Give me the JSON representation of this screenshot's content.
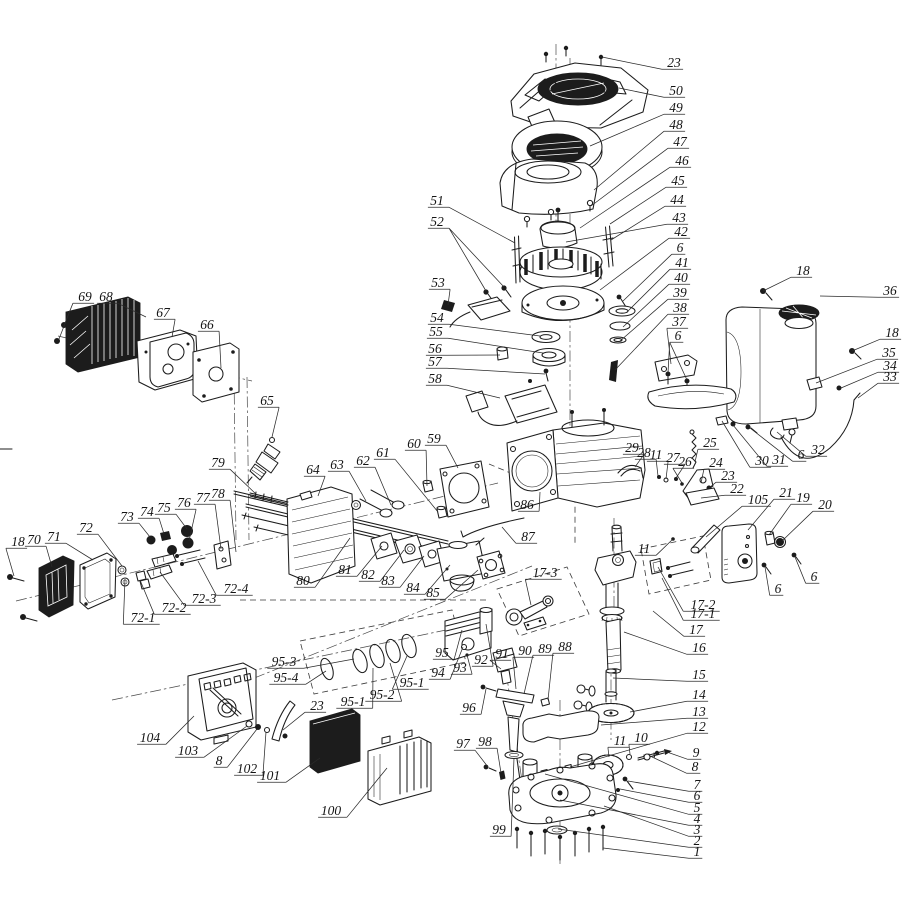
{
  "canvas": {
    "width": 905,
    "height": 905,
    "background": "#ffffff",
    "ink": "#1c1c1c"
  },
  "callouts": [
    {
      "n": "23",
      "x": 674,
      "y": 63,
      "t": [
        [
          602,
          57
        ]
      ]
    },
    {
      "n": "50",
      "x": 676,
      "y": 91,
      "t": [
        [
          619,
          88
        ]
      ]
    },
    {
      "n": "49",
      "x": 676,
      "y": 108,
      "t": [
        [
          590,
          146
        ]
      ]
    },
    {
      "n": "48",
      "x": 676,
      "y": 125,
      "t": [
        [
          594,
          190
        ]
      ]
    },
    {
      "n": "47",
      "x": 680,
      "y": 142,
      "t": [
        [
          591,
          206
        ]
      ]
    },
    {
      "n": "46",
      "x": 682,
      "y": 161,
      "t": [
        [
          580,
          228
        ]
      ]
    },
    {
      "n": "45",
      "x": 678,
      "y": 181,
      "t": [
        [
          610,
          224
        ]
      ]
    },
    {
      "n": "44",
      "x": 677,
      "y": 200,
      "t": [
        [
          611,
          240
        ]
      ]
    },
    {
      "n": "43",
      "x": 679,
      "y": 218,
      "t": [
        [
          566,
          242
        ]
      ]
    },
    {
      "n": "42",
      "x": 681,
      "y": 232,
      "t": [
        [
          600,
          290
        ]
      ]
    },
    {
      "n": "6",
      "x": 680,
      "y": 248,
      "t": [
        [
          623,
          301
        ]
      ]
    },
    {
      "n": "41",
      "x": 682,
      "y": 263,
      "t": [
        [
          627,
          312
        ]
      ]
    },
    {
      "n": "40",
      "x": 681,
      "y": 278,
      "t": [
        [
          623,
          327
        ]
      ]
    },
    {
      "n": "39",
      "x": 680,
      "y": 293,
      "t": [
        [
          620,
          341
        ]
      ]
    },
    {
      "n": "38",
      "x": 680,
      "y": 308,
      "t": [
        [
          615,
          370
        ]
      ]
    },
    {
      "n": "37",
      "x": 679,
      "y": 322,
      "t": [
        [
          671,
          364
        ]
      ]
    },
    {
      "n": "6",
      "x": 678,
      "y": 336,
      "t": [
        [
          668,
          373
        ],
        [
          687,
          380
        ]
      ]
    },
    {
      "n": "18",
      "x": 803,
      "y": 271,
      "t": [
        [
          763,
          291
        ]
      ]
    },
    {
      "n": "36",
      "x": 890,
      "y": 291,
      "t": [
        [
          820,
          296
        ]
      ]
    },
    {
      "n": "18",
      "x": 892,
      "y": 333,
      "t": [
        [
          852,
          351
        ]
      ]
    },
    {
      "n": "35",
      "x": 889,
      "y": 353,
      "t": [
        [
          816,
          383
        ]
      ]
    },
    {
      "n": "34",
      "x": 890,
      "y": 366,
      "t": [
        [
          841,
          388
        ]
      ]
    },
    {
      "n": "33",
      "x": 890,
      "y": 377,
      "t": [
        [
          858,
          398
        ]
      ]
    },
    {
      "n": "51",
      "x": 437,
      "y": 201,
      "t": [
        [
          515,
          243
        ]
      ]
    },
    {
      "n": "52",
      "x": 437,
      "y": 222,
      "t": [
        [
          486,
          291
        ],
        [
          504,
          287
        ]
      ]
    },
    {
      "n": "53",
      "x": 438,
      "y": 283,
      "t": [
        [
          448,
          305
        ]
      ]
    },
    {
      "n": "54",
      "x": 437,
      "y": 318,
      "t": [
        [
          540,
          336
        ]
      ]
    },
    {
      "n": "55",
      "x": 436,
      "y": 332,
      "t": [
        [
          543,
          353
        ]
      ]
    },
    {
      "n": "56",
      "x": 435,
      "y": 349,
      "t": [
        [
          500,
          355
        ]
      ]
    },
    {
      "n": "57",
      "x": 435,
      "y": 362,
      "t": [
        [
          545,
          374
        ]
      ]
    },
    {
      "n": "58",
      "x": 435,
      "y": 379,
      "t": [
        [
          500,
          398
        ]
      ]
    },
    {
      "n": "69",
      "x": 85,
      "y": 297,
      "t": [
        [
          65,
          323
        ],
        [
          59,
          339
        ]
      ]
    },
    {
      "n": "68",
      "x": 106,
      "y": 297,
      "t": [
        [
          146,
          317
        ]
      ]
    },
    {
      "n": "67",
      "x": 163,
      "y": 313,
      "t": [
        [
          172,
          337
        ]
      ]
    },
    {
      "n": "66",
      "x": 207,
      "y": 325,
      "t": [
        [
          221,
          368
        ]
      ]
    },
    {
      "n": "65",
      "x": 267,
      "y": 401,
      "t": [
        [
          272,
          437
        ]
      ]
    },
    {
      "n": "79",
      "x": 218,
      "y": 463,
      "t": [
        [
          257,
          495
        ]
      ]
    },
    {
      "n": "18",
      "x": 18,
      "y": 542,
      "t": [
        [
          14,
          576
        ]
      ]
    },
    {
      "n": "70",
      "x": 34,
      "y": 540,
      "t": [
        [
          52,
          567
        ]
      ]
    },
    {
      "n": "71",
      "x": 54,
      "y": 537,
      "t": [
        [
          93,
          560
        ]
      ]
    },
    {
      "n": "72",
      "x": 86,
      "y": 528,
      "t": [
        [
          122,
          566
        ]
      ]
    },
    {
      "n": "73",
      "x": 127,
      "y": 517,
      "t": [
        [
          150,
          537
        ]
      ]
    },
    {
      "n": "74",
      "x": 147,
      "y": 512,
      "t": [
        [
          164,
          534
        ]
      ]
    },
    {
      "n": "75",
      "x": 164,
      "y": 508,
      "t": [
        [
          187,
          529
        ]
      ]
    },
    {
      "n": "76",
      "x": 184,
      "y": 503,
      "t": [
        [
          189,
          541
        ]
      ]
    },
    {
      "n": "77",
      "x": 203,
      "y": 498,
      "t": [
        [
          221,
          549
        ]
      ]
    },
    {
      "n": "78",
      "x": 218,
      "y": 494,
      "t": [
        [
          236,
          552
        ]
      ]
    },
    {
      "n": "72-1",
      "x": 143,
      "y": 618,
      "t": [
        [
          125,
          579
        ]
      ]
    },
    {
      "n": "72-2",
      "x": 174,
      "y": 608,
      "t": [
        [
          140,
          580
        ]
      ]
    },
    {
      "n": "72-3",
      "x": 204,
      "y": 599,
      "t": [
        [
          160,
          572
        ]
      ]
    },
    {
      "n": "72-4",
      "x": 236,
      "y": 589,
      "t": [
        [
          198,
          561
        ]
      ]
    },
    {
      "n": "64",
      "x": 313,
      "y": 470,
      "t": [
        [
          318,
          496
        ]
      ]
    },
    {
      "n": "63",
      "x": 337,
      "y": 465,
      "t": [
        [
          366,
          501
        ]
      ]
    },
    {
      "n": "62",
      "x": 363,
      "y": 461,
      "t": [
        [
          391,
          505
        ]
      ]
    },
    {
      "n": "61",
      "x": 383,
      "y": 453,
      "t": [
        [
          438,
          512
        ]
      ]
    },
    {
      "n": "60",
      "x": 414,
      "y": 444,
      "t": [
        [
          427,
          486
        ]
      ]
    },
    {
      "n": "59",
      "x": 434,
      "y": 439,
      "t": [
        [
          458,
          468
        ]
      ]
    },
    {
      "n": "86",
      "x": 527,
      "y": 505,
      "t": [
        [
          540,
          492
        ]
      ]
    },
    {
      "n": "87",
      "x": 528,
      "y": 537,
      "t": [
        [
          502,
          527
        ]
      ]
    },
    {
      "n": "80",
      "x": 303,
      "y": 581,
      "t": [
        [
          350,
          538
        ]
      ]
    },
    {
      "n": "81",
      "x": 345,
      "y": 570,
      "t": [
        [
          382,
          546
        ]
      ]
    },
    {
      "n": "82",
      "x": 368,
      "y": 575,
      "t": [
        [
          404,
          550
        ]
      ]
    },
    {
      "n": "83",
      "x": 388,
      "y": 581,
      "t": [
        [
          424,
          556
        ]
      ]
    },
    {
      "n": "84",
      "x": 413,
      "y": 588,
      "t": [
        [
          450,
          565
        ]
      ]
    },
    {
      "n": "85",
      "x": 433,
      "y": 593,
      "t": [
        [
          478,
          570
        ]
      ]
    },
    {
      "n": "17-3",
      "x": 545,
      "y": 573,
      "t": [
        [
          531,
          605
        ]
      ]
    },
    {
      "n": "95-3",
      "x": 284,
      "y": 662,
      "t": [
        [
          354,
          659
        ]
      ]
    },
    {
      "n": "95-4",
      "x": 286,
      "y": 678,
      "t": [
        [
          326,
          671
        ]
      ]
    },
    {
      "n": "95-1",
      "x": 353,
      "y": 702,
      "t": [
        [
          373,
          668
        ]
      ]
    },
    {
      "n": "95-2",
      "x": 382,
      "y": 695,
      "t": [
        [
          390,
          663
        ]
      ]
    },
    {
      "n": "95-1",
      "x": 412,
      "y": 683,
      "t": [
        [
          407,
          656
        ]
      ]
    },
    {
      "n": "95",
      "x": 442,
      "y": 653,
      "t": [
        [
          462,
          630
        ]
      ]
    },
    {
      "n": "94",
      "x": 438,
      "y": 673,
      "t": [
        [
          463,
          647
        ]
      ]
    },
    {
      "n": "93",
      "x": 460,
      "y": 668,
      "t": [
        [
          467,
          655
        ]
      ]
    },
    {
      "n": "92",
      "x": 481,
      "y": 660,
      "t": [
        [
          486,
          624
        ]
      ]
    },
    {
      "n": "91",
      "x": 502,
      "y": 654,
      "t": [
        [
          501,
          669
        ]
      ]
    },
    {
      "n": "90",
      "x": 525,
      "y": 651,
      "t": [
        [
          516,
          689
        ]
      ]
    },
    {
      "n": "89",
      "x": 545,
      "y": 649,
      "t": [
        [
          524,
          694
        ]
      ]
    },
    {
      "n": "88",
      "x": 565,
      "y": 647,
      "t": [
        [
          548,
          700
        ]
      ]
    },
    {
      "n": "96",
      "x": 469,
      "y": 708,
      "t": [
        [
          486,
          689
        ]
      ]
    },
    {
      "n": "97",
      "x": 463,
      "y": 744,
      "t": [
        [
          488,
          767
        ]
      ]
    },
    {
      "n": "98",
      "x": 485,
      "y": 742,
      "t": [
        [
          501,
          773
        ]
      ]
    },
    {
      "n": "104",
      "x": 150,
      "y": 738,
      "t": [
        [
          194,
          716
        ]
      ]
    },
    {
      "n": "103",
      "x": 188,
      "y": 751,
      "t": [
        [
          247,
          726
        ]
      ]
    },
    {
      "n": "8",
      "x": 219,
      "y": 761,
      "t": [
        [
          257,
          729
        ]
      ]
    },
    {
      "n": "102",
      "x": 247,
      "y": 769,
      "t": [
        [
          266,
          732
        ]
      ]
    },
    {
      "n": "101",
      "x": 270,
      "y": 776,
      "t": [
        [
          320,
          758
        ]
      ]
    },
    {
      "n": "23",
      "x": 317,
      "y": 706,
      "t": [
        [
          283,
          730
        ]
      ]
    },
    {
      "n": "100",
      "x": 331,
      "y": 811,
      "t": [
        [
          387,
          768
        ]
      ]
    },
    {
      "n": "29",
      "x": 632,
      "y": 448,
      "t": [
        [
          635,
          467
        ]
      ]
    },
    {
      "n": "28",
      "x": 644,
      "y": 453,
      "t": [
        [
          658,
          476
        ]
      ]
    },
    {
      "n": "11",
      "x": 656,
      "y": 455,
      "t": [
        [
          666,
          479
        ]
      ]
    },
    {
      "n": "27",
      "x": 673,
      "y": 458,
      "t": [
        [
          676,
          478
        ]
      ]
    },
    {
      "n": "26",
      "x": 685,
      "y": 462,
      "t": [
        [
          682,
          483
        ]
      ]
    },
    {
      "n": "25",
      "x": 710,
      "y": 443,
      "t": [
        [
          695,
          462
        ]
      ]
    },
    {
      "n": "24",
      "x": 716,
      "y": 463,
      "t": [
        [
          701,
          483
        ]
      ]
    },
    {
      "n": "23",
      "x": 728,
      "y": 476,
      "t": [
        [
          709,
          488
        ]
      ]
    },
    {
      "n": "22",
      "x": 737,
      "y": 489,
      "t": [
        [
          701,
          498
        ]
      ]
    },
    {
      "n": "30",
      "x": 762,
      "y": 461,
      "t": [
        [
          722,
          421
        ]
      ]
    },
    {
      "n": "31",
      "x": 779,
      "y": 460,
      "t": [
        [
          733,
          425
        ]
      ]
    },
    {
      "n": "6",
      "x": 801,
      "y": 455,
      "t": [
        [
          750,
          428
        ]
      ]
    },
    {
      "n": "32",
      "x": 818,
      "y": 450,
      "t": [
        [
          777,
          432
        ]
      ]
    },
    {
      "n": "105",
      "x": 758,
      "y": 500,
      "t": [
        [
          706,
          537
        ]
      ]
    },
    {
      "n": "21",
      "x": 786,
      "y": 493,
      "t": [
        [
          748,
          530
        ]
      ]
    },
    {
      "n": "19",
      "x": 803,
      "y": 498,
      "t": [
        [
          769,
          535
        ]
      ]
    },
    {
      "n": "20",
      "x": 825,
      "y": 505,
      "t": [
        [
          782,
          541
        ]
      ]
    },
    {
      "n": "11",
      "x": 644,
      "y": 549,
      "t": [
        [
          673,
          539
        ]
      ]
    },
    {
      "n": "6",
      "x": 778,
      "y": 589,
      "t": [
        [
          765,
          567
        ]
      ]
    },
    {
      "n": "6",
      "x": 814,
      "y": 577,
      "t": [
        [
          795,
          557
        ]
      ]
    },
    {
      "n": "17-2",
      "x": 703,
      "y": 605,
      "t": [
        [
          658,
          567
        ]
      ]
    },
    {
      "n": "17-1",
      "x": 703,
      "y": 614,
      "t": [
        [
          662,
          578
        ]
      ]
    },
    {
      "n": "17",
      "x": 696,
      "y": 630,
      "t": [
        [
          653,
          611
        ]
      ]
    },
    {
      "n": "16",
      "x": 699,
      "y": 648,
      "t": [
        [
          624,
          632
        ]
      ]
    },
    {
      "n": "15",
      "x": 699,
      "y": 675,
      "t": [
        [
          613,
          678
        ]
      ]
    },
    {
      "n": "14",
      "x": 699,
      "y": 695,
      "t": [
        [
          630,
          712
        ]
      ]
    },
    {
      "n": "13",
      "x": 699,
      "y": 712,
      "t": [
        [
          601,
          725
        ]
      ]
    },
    {
      "n": "12",
      "x": 699,
      "y": 727,
      "t": [
        [
          570,
          767
        ]
      ]
    },
    {
      "n": "11",
      "x": 620,
      "y": 741,
      "t": [
        [
          609,
          757
        ]
      ]
    },
    {
      "n": "10",
      "x": 641,
      "y": 738,
      "t": [
        [
          630,
          754
        ]
      ]
    },
    {
      "n": "9",
      "x": 696,
      "y": 753,
      "t": [
        [
          667,
          752
        ]
      ]
    },
    {
      "n": "8",
      "x": 695,
      "y": 767,
      "t": [
        [
          650,
          756
        ]
      ]
    },
    {
      "n": "7",
      "x": 697,
      "y": 785,
      "t": [
        [
          628,
          781
        ]
      ]
    },
    {
      "n": "6",
      "x": 697,
      "y": 796,
      "t": [
        [
          620,
          789
        ]
      ]
    },
    {
      "n": "5",
      "x": 697,
      "y": 808,
      "t": [
        [
          545,
          774
        ]
      ]
    },
    {
      "n": "4",
      "x": 697,
      "y": 819,
      "t": [
        [
          560,
          800
        ]
      ]
    },
    {
      "n": "3",
      "x": 697,
      "y": 830,
      "t": [
        [
          604,
          806
        ]
      ]
    },
    {
      "n": "2",
      "x": 697,
      "y": 841,
      "t": [
        [
          558,
          829
        ]
      ]
    },
    {
      "n": "1",
      "x": 697,
      "y": 852,
      "t": [
        [
          603,
          848
        ]
      ]
    },
    {
      "n": "99",
      "x": 499,
      "y": 830,
      "t": [
        [
          514,
          758
        ]
      ]
    }
  ]
}
